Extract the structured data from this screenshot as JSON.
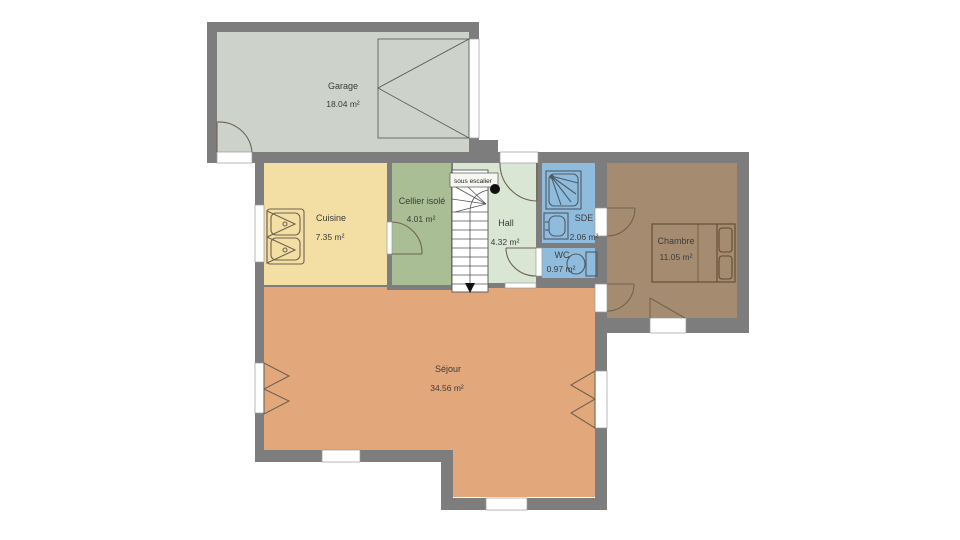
{
  "title": "Floor plan",
  "colors": {
    "wall": "#7d7d7d",
    "garage": "#cdd2ca",
    "cuisine": "#f3dfa3",
    "cellier": "#aabe95",
    "hall": "#d9e6d3",
    "water": "#8fbcdd",
    "chambre": "#a58c71",
    "sejour": "#e2a87b",
    "background": "#ffffff"
  },
  "rooms": [
    {
      "id": "garage",
      "label": "Garage",
      "area": "18.04 m²"
    },
    {
      "id": "cuisine",
      "label": "Cuisine",
      "area": "7.35 m²"
    },
    {
      "id": "cellier",
      "label": "Cellier isolé",
      "area": "4.01 m²"
    },
    {
      "id": "hall",
      "label": "Hall",
      "area": "4.32 m²"
    },
    {
      "id": "sde",
      "label": "SDE",
      "area": "2.06 m²"
    },
    {
      "id": "wc",
      "label": "WC",
      "area": "0.97 m²"
    },
    {
      "id": "chambre",
      "label": "Chambre",
      "area": "11.05 m²"
    },
    {
      "id": "sejour",
      "label": "Séjour",
      "area": "34.56 m²"
    }
  ],
  "annotations": {
    "stairs_note": "sous escalier"
  }
}
